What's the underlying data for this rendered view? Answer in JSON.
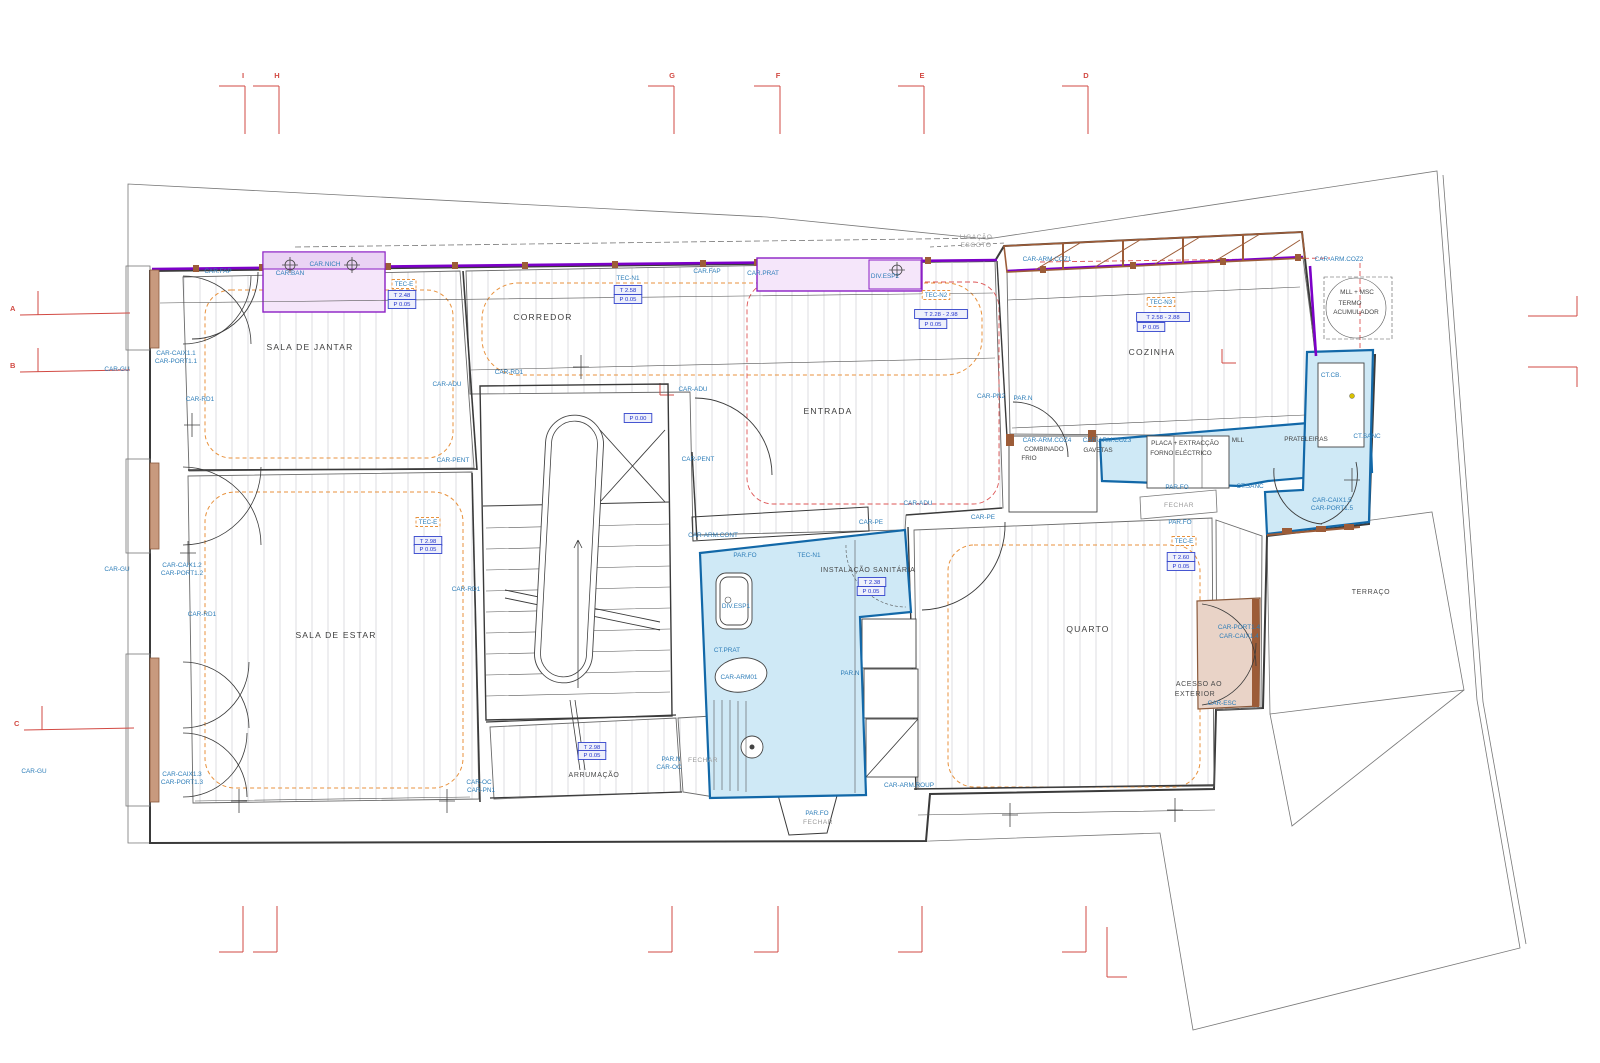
{
  "drawing": {
    "type": "architectural-floor-plan",
    "language": "pt",
    "canvas": {
      "width": 1600,
      "height": 1063
    }
  },
  "colors": {
    "wet_area_fill": "#cfe9f6",
    "wet_area_stroke": "#1268a8",
    "carpentry_purple": "#7c00c8",
    "lilac_fill": "#f5e6fa",
    "annotation_blue": "#2d7db8",
    "dim_box_blue": "#2233cc",
    "ceiling_orange": "#e8913c",
    "sanitation_red": "#dd5555",
    "grid_red": "#d24a43",
    "wood_brown": "#9c5c38"
  },
  "rooms": [
    {
      "name": "SALA DE JANTAR",
      "x": 310,
      "y": 350
    },
    {
      "name": "CORREDOR",
      "x": 543,
      "y": 320
    },
    {
      "name": "ENTRADA",
      "x": 828,
      "y": 414
    },
    {
      "name": "COZINHA",
      "x": 1152,
      "y": 355
    },
    {
      "name": "SALA DE ESTAR",
      "x": 336,
      "y": 638
    },
    {
      "name": "INSTALAÇÃO SANITÁRIA",
      "x": 868,
      "y": 572,
      "size": "sm"
    },
    {
      "name": "QUARTO",
      "x": 1088,
      "y": 632
    },
    {
      "name": "ARRUMAÇÃO",
      "x": 594,
      "y": 777,
      "size": "sm"
    },
    {
      "name": "TERRAÇO",
      "x": 1371,
      "y": 594,
      "size": "sm"
    },
    {
      "name": "ACESSO AO",
      "x": 1199,
      "y": 686,
      "size": "sm"
    },
    {
      "name": "EXTERIOR",
      "x": 1195,
      "y": 696,
      "size": "sm"
    }
  ],
  "labels": [
    {
      "t": "CAR.FAP",
      "x": 218,
      "y": 273
    },
    {
      "t": "CAR.NICH",
      "x": 325,
      "y": 266
    },
    {
      "t": "CAR.BAN",
      "x": 290,
      "y": 275
    },
    {
      "t": "CAR-CAIX1.1",
      "x": 176,
      "y": 355
    },
    {
      "t": "CAR-PORT1.1",
      "x": 176,
      "y": 363
    },
    {
      "t": "CAR-GU",
      "x": 117,
      "y": 371
    },
    {
      "t": "CAR-RD1",
      "x": 200,
      "y": 401
    },
    {
      "t": "CAR-ADU",
      "x": 447,
      "y": 386
    },
    {
      "t": "CAR-RD1",
      "x": 509,
      "y": 374
    },
    {
      "t": "CAR-PENT",
      "x": 453,
      "y": 462
    },
    {
      "t": "CAR-ADU",
      "x": 693,
      "y": 391
    },
    {
      "t": "CAR-PENT",
      "x": 698,
      "y": 461
    },
    {
      "t": "TEC-N1",
      "x": 628,
      "y": 280
    },
    {
      "t": "CAR.FAP",
      "x": 707,
      "y": 273
    },
    {
      "t": "CAR.PRAT",
      "x": 763,
      "y": 275
    },
    {
      "t": "DIV.ESP2",
      "x": 885,
      "y": 278
    },
    {
      "t": "CAR-PN2",
      "x": 991,
      "y": 398
    },
    {
      "t": "PAR.N",
      "x": 1023,
      "y": 400
    },
    {
      "t": "CAR-ARM.COZ1",
      "x": 1047,
      "y": 261
    },
    {
      "t": "CAR-ARM.COZ2",
      "x": 1339,
      "y": 261
    },
    {
      "t": "CT.CB.",
      "x": 1331,
      "y": 377
    },
    {
      "t": "CT.SANC",
      "x": 1367,
      "y": 438
    },
    {
      "t": "CAR-ARM.COZ4",
      "x": 1047,
      "y": 442
    },
    {
      "t": "COMBINADO",
      "x": 1044,
      "y": 451,
      "cls": "dark"
    },
    {
      "t": "FRIO",
      "x": 1029,
      "y": 460,
      "cls": "dark"
    },
    {
      "t": "CAR-ARM.COZ3",
      "x": 1107,
      "y": 442
    },
    {
      "t": "GAVETAS",
      "x": 1098,
      "y": 452,
      "cls": "dark"
    },
    {
      "t": "PLACA + EXTRACÇÃO",
      "x": 1185,
      "y": 445,
      "cls": "dark"
    },
    {
      "t": "FORNO ELÉCTRICO",
      "x": 1181,
      "y": 455,
      "cls": "dark"
    },
    {
      "t": "MLL",
      "x": 1238,
      "y": 442,
      "cls": "dark"
    },
    {
      "t": "PRATELEIRAS",
      "x": 1306,
      "y": 441,
      "cls": "dark"
    },
    {
      "t": "MLL + MSC",
      "x": 1357,
      "y": 294,
      "cls": "dark"
    },
    {
      "t": "TERMO",
      "x": 1350,
      "y": 305,
      "cls": "dark"
    },
    {
      "t": "ACUMULADOR",
      "x": 1356,
      "y": 314,
      "cls": "dark"
    },
    {
      "t": "LIGAÇÃO",
      "x": 976,
      "y": 239,
      "cls": "gray"
    },
    {
      "t": "ESGOTO",
      "x": 976,
      "y": 247,
      "cls": "gray"
    },
    {
      "t": "PAR.FO",
      "x": 1177,
      "y": 489
    },
    {
      "t": "FECHAR",
      "x": 1179,
      "y": 507,
      "cls": "gray"
    },
    {
      "t": "CT.SANC",
      "x": 1250,
      "y": 488
    },
    {
      "t": "CAR-CAIX1.5",
      "x": 1332,
      "y": 502
    },
    {
      "t": "CAR-PORT1.5",
      "x": 1332,
      "y": 510
    },
    {
      "t": "CAR-GU",
      "x": 117,
      "y": 571
    },
    {
      "t": "CAR-CAIX1.2",
      "x": 182,
      "y": 567
    },
    {
      "t": "CAR-PORT1.2",
      "x": 182,
      "y": 575
    },
    {
      "t": "CAR-RD1",
      "x": 202,
      "y": 616
    },
    {
      "t": "CAR-RD1",
      "x": 466,
      "y": 591
    },
    {
      "t": "CAR-ARM.CONT",
      "x": 713,
      "y": 537
    },
    {
      "t": "CAR-PE",
      "x": 871,
      "y": 524
    },
    {
      "t": "CAR-ADU",
      "x": 918,
      "y": 505
    },
    {
      "t": "CAR-PE",
      "x": 983,
      "y": 519
    },
    {
      "t": "PAR.FO",
      "x": 745,
      "y": 557
    },
    {
      "t": "TEC-N1",
      "x": 809,
      "y": 557
    },
    {
      "t": "DIV.ESP1",
      "x": 736,
      "y": 608
    },
    {
      "t": "CT.PRAT",
      "x": 727,
      "y": 652
    },
    {
      "t": "CAR-ARM01",
      "x": 739,
      "y": 679
    },
    {
      "t": "PAR.N",
      "x": 850,
      "y": 675
    },
    {
      "t": "CAR-ARM.ROUP",
      "x": 909,
      "y": 787
    },
    {
      "t": "PAR.N",
      "x": 671,
      "y": 761
    },
    {
      "t": "CAR-OC",
      "x": 669,
      "y": 769
    },
    {
      "t": "FECHAR",
      "x": 703,
      "y": 762,
      "cls": "gray"
    },
    {
      "t": "CAR-OC",
      "x": 479,
      "y": 784
    },
    {
      "t": "CAR-PN1",
      "x": 481,
      "y": 792
    },
    {
      "t": "CAR-CAIX1.3",
      "x": 182,
      "y": 776
    },
    {
      "t": "CAR-PORT1.3",
      "x": 182,
      "y": 784
    },
    {
      "t": "CAR-GU",
      "x": 34,
      "y": 773
    },
    {
      "t": "PAR.FO",
      "x": 817,
      "y": 815
    },
    {
      "t": "FECHAR",
      "x": 818,
      "y": 824,
      "cls": "gray"
    },
    {
      "t": "PAR.FO",
      "x": 1180,
      "y": 524
    },
    {
      "t": "CAR-PORT1.4",
      "x": 1239,
      "y": 629
    },
    {
      "t": "CAR-CAIX1.4",
      "x": 1239,
      "y": 638
    },
    {
      "t": "CAR-ESC",
      "x": 1222,
      "y": 705
    }
  ],
  "dim_boxes": [
    {
      "t": "TEC-E",
      "x": 404,
      "y": 286,
      "cls": "orange"
    },
    {
      "t": "T 2.48",
      "x": 402,
      "y": 297
    },
    {
      "t": "P 0.05",
      "x": 402,
      "y": 306
    },
    {
      "t": "T 2.58",
      "x": 628,
      "y": 292
    },
    {
      "t": "P 0.05",
      "x": 628,
      "y": 301
    },
    {
      "t": "TEC-N2",
      "x": 936,
      "y": 297,
      "cls": "orange"
    },
    {
      "t": "T 2.28 - 2.98",
      "x": 941,
      "y": 316
    },
    {
      "t": "P 0.05",
      "x": 933,
      "y": 326
    },
    {
      "t": "TEC-N3",
      "x": 1161,
      "y": 304,
      "cls": "orange"
    },
    {
      "t": "T 2.58 - 2.88",
      "x": 1163,
      "y": 319
    },
    {
      "t": "P 0.05",
      "x": 1151,
      "y": 329
    },
    {
      "t": "P 0.00",
      "x": 638,
      "y": 420
    },
    {
      "t": "TEC-E",
      "x": 428,
      "y": 524,
      "cls": "orange"
    },
    {
      "t": "T 2.98",
      "x": 428,
      "y": 543
    },
    {
      "t": "P 0.05",
      "x": 428,
      "y": 551
    },
    {
      "t": "T 2.38",
      "x": 872,
      "y": 584
    },
    {
      "t": "P 0.05",
      "x": 871,
      "y": 593
    },
    {
      "t": "TEC-E",
      "x": 1184,
      "y": 543,
      "cls": "orange"
    },
    {
      "t": "T 2.60",
      "x": 1181,
      "y": 559
    },
    {
      "t": "P 0.05",
      "x": 1181,
      "y": 568
    },
    {
      "t": "T 2.98",
      "x": 592,
      "y": 749
    },
    {
      "t": "P 0.05",
      "x": 592,
      "y": 757
    }
  ],
  "grid_markers": {
    "top": [
      {
        "letter": "I",
        "x": 243
      },
      {
        "letter": "H",
        "x": 277
      },
      {
        "letter": "G",
        "x": 672
      },
      {
        "letter": "F",
        "x": 778
      },
      {
        "letter": "E",
        "x": 922
      },
      {
        "letter": "D",
        "x": 1086
      }
    ],
    "bottom_x": [
      243,
      277,
      672,
      778,
      922,
      1086
    ],
    "left": [
      {
        "letter": "A",
        "x": 10,
        "y": 311
      },
      {
        "letter": "B",
        "x": 10,
        "y": 368
      },
      {
        "letter": "C",
        "x": 14,
        "y": 726
      }
    ],
    "right_y": [
      316,
      367
    ]
  }
}
